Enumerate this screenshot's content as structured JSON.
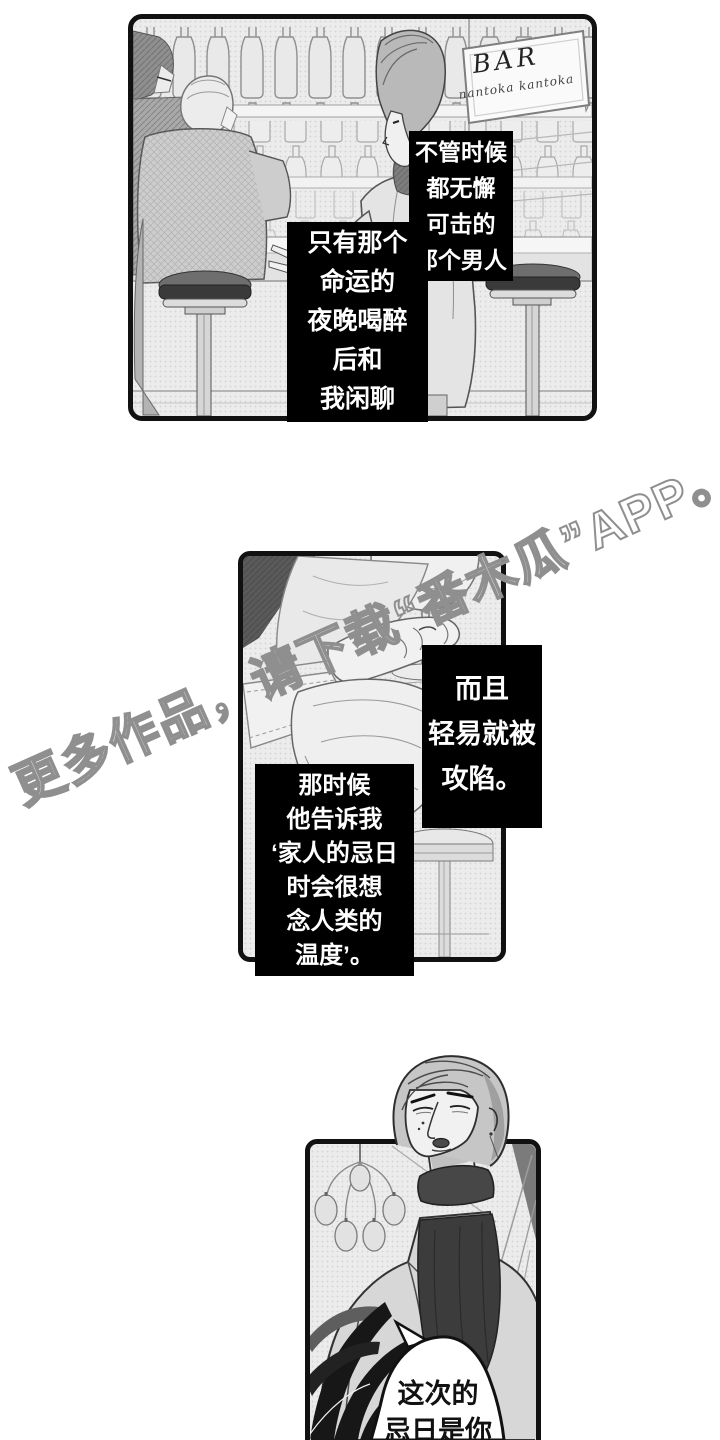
{
  "watermark": {
    "text": "更多作品，请下载“番木瓜”APP。",
    "color": "#8f8f8f"
  },
  "panel_bar": {
    "sign": {
      "title": "BAR",
      "subtitle": "nantoka kantoka"
    },
    "caption_time": {
      "lines": [
        "不管时候",
        "都无懈",
        "可击的",
        "那个男人"
      ]
    },
    "caption_night": {
      "lines": [
        "只有那个",
        "命运的",
        "夜晚喝醉",
        "后和",
        "我闲聊"
      ]
    }
  },
  "panel_hands": {
    "caption_easy": {
      "lines": [
        "而且",
        "轻易就被",
        "攻陷。"
      ]
    },
    "caption_told": {
      "lines": [
        "那时候",
        "他告诉我",
        "‘家人的忌日",
        "时会很想",
        "念人类的",
        "温度’。"
      ]
    }
  },
  "panel_man": {
    "bubble": {
      "lines": [
        "这次的",
        "忌日是你"
      ]
    }
  },
  "colors": {
    "caption_bg": "#000000",
    "caption_text": "#ffffff",
    "panel_border": "#111111",
    "panel_fill": "#ececec",
    "watermark_stroke": "#8f8f8f"
  }
}
